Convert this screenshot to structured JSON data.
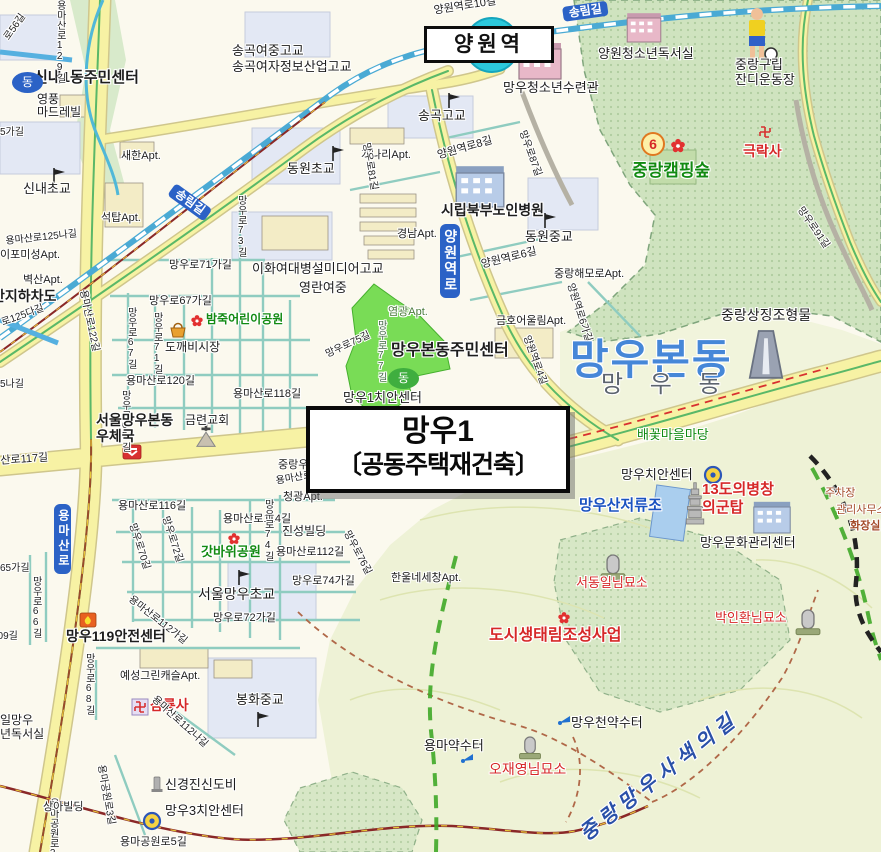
{
  "station": {
    "name": "양원역"
  },
  "callout": {
    "line1": "망우1",
    "line2": "〔공동주택재건축〕"
  },
  "colors": {
    "highlight_zone": "#5cd634",
    "road_yellow": "#f7f2a4",
    "forest_green": "#cfe3bf",
    "railway_blue": "#4aaad4",
    "badge_blue": "#2b62c6",
    "poi_red": "#d62828",
    "park_green": "#128a12",
    "district_blue": "#4687d8"
  },
  "labels": [
    {
      "n": "yangwonyeokro-10gil",
      "t": "양원역로10길",
      "x": 433,
      "y": 5,
      "fs": 11,
      "r": -9
    },
    {
      "n": "songnimgil-badge-top",
      "t": "송림길",
      "x": 562,
      "y": 7,
      "fs": 12,
      "bg": "#2b62c6",
      "r": -8,
      "b": 1
    },
    {
      "n": "songgok-girls-mid-high",
      "t": "송곡여중고교",
      "x": 232,
      "y": 44,
      "fs": 13
    },
    {
      "n": "songgok-girls-info-high",
      "t": "송곡여자정보산업고교",
      "x": 232,
      "y": 60,
      "fs": 13
    },
    {
      "n": "sinnae1-community-center",
      "t": "신내1동주민센터",
      "x": 34,
      "y": 70,
      "fs": 15,
      "b": 1
    },
    {
      "n": "dong-office-icon-sinnae",
      "t": "동",
      "x": 12,
      "y": 72,
      "fs": 12,
      "c": "#fff",
      "bg": "#2b62c6",
      "br": "50%",
      "wd": 19,
      "hg": 19
    },
    {
      "n": "yeongpung-madrevil",
      "t": "영풍\n마드레빌",
      "x": 37,
      "y": 93,
      "fs": 12
    },
    {
      "n": "sinnae-elementary",
      "t": "신내초교",
      "x": 23,
      "y": 182,
      "fs": 13
    },
    {
      "n": "saehan-apt",
      "t": "새한Apt.",
      "x": 121,
      "y": 150,
      "fs": 11
    },
    {
      "n": "seoktap-apt",
      "t": "석탑Apt.",
      "x": 101,
      "y": 212,
      "fs": 11
    },
    {
      "n": "yongmasanro-129gil",
      "t": "용마산로129길",
      "x": 54,
      "y": 0,
      "fs": 10,
      "v": 1
    },
    {
      "n": "ro-56gil",
      "t": "로56길",
      "x": 2,
      "y": 36,
      "fs": 10,
      "r": -55
    },
    {
      "n": "partial-5gagil",
      "t": "5가길",
      "x": 0,
      "y": 127,
      "fs": 10
    },
    {
      "n": "yongmasanro-125nagil",
      "t": "용마산로125나길",
      "x": 5,
      "y": 236,
      "fs": 10,
      "r": -6
    },
    {
      "n": "haipomiseong-apt",
      "t": "이포미성Apt.",
      "x": 0,
      "y": 249,
      "fs": 11
    },
    {
      "n": "byeoksan-apt",
      "t": "벽산Apt.",
      "x": 23,
      "y": 274,
      "fs": 11
    },
    {
      "n": "underpass",
      "t": "안지하차도",
      "x": -8,
      "y": 289,
      "fs": 14,
      "b": 1
    },
    {
      "n": "yongmasanro-125dagil",
      "t": "로125다길",
      "x": 0,
      "y": 318,
      "fs": 10,
      "r": -20
    },
    {
      "n": "partial-5nagil",
      "t": "5나길",
      "x": 0,
      "y": 379,
      "fs": 10
    },
    {
      "n": "partial-65gagil",
      "t": "65가길",
      "x": 0,
      "y": 563,
      "fs": 10
    },
    {
      "n": "songnimgil-badge-west",
      "t": "송림길",
      "x": 176,
      "y": 183,
      "fs": 12,
      "bg": "#2b62c6",
      "r": 36,
      "b": 1
    },
    {
      "n": "mangwooro-73gil",
      "t": "망우로73길",
      "x": 235,
      "y": 195,
      "fs": 10,
      "v": 1
    },
    {
      "n": "dongwon-elementary",
      "t": "동원초교",
      "x": 287,
      "y": 162,
      "fs": 13
    },
    {
      "n": "gaenari-apt",
      "t": "개나리Apt.",
      "x": 361,
      "y": 149,
      "fs": 11
    },
    {
      "n": "songgok-high",
      "t": "송곡고교",
      "x": 418,
      "y": 109,
      "fs": 13
    },
    {
      "n": "yangwonyeokro-8gil",
      "t": "양원역로8길",
      "x": 436,
      "y": 150,
      "fs": 11,
      "r": -16
    },
    {
      "n": "mangwoo-youth-center",
      "t": "망우청소년수련관",
      "x": 503,
      "y": 81,
      "fs": 13
    },
    {
      "n": "mangwooro-87gil",
      "t": "망우로87길",
      "x": 527,
      "y": 129,
      "fs": 10,
      "r": 70
    },
    {
      "n": "yangwon-youth-reading",
      "t": "양원청소년독서실",
      "x": 598,
      "y": 47,
      "fs": 13
    },
    {
      "n": "jungnang-lawn-field",
      "t": "중랑구립\n잔디운동장",
      "x": 735,
      "y": 58,
      "fs": 13
    },
    {
      "n": "geukraksa-temple",
      "t": "극락사",
      "x": 743,
      "y": 144,
      "fs": 14,
      "c": "#d62828",
      "b": 1
    },
    {
      "n": "six-marker",
      "t": "6",
      "x": 641,
      "y": 132,
      "fs": 14,
      "c": "#d62828",
      "b": 1,
      "bg": "#fdf0a8",
      "bd": "2px solid #e07820",
      "br": "50%",
      "wd": 20,
      "hg": 20
    },
    {
      "n": "jungnang-camping-forest",
      "t": "중랑캠핑숲",
      "x": 632,
      "y": 161,
      "fs": 17,
      "c": "#128a12",
      "b": 1
    },
    {
      "n": "ehwa-media-high",
      "t": "이화여대병설미디어고교",
      "x": 252,
      "y": 262,
      "fs": 13
    },
    {
      "n": "yeongnan-girls-mid",
      "t": "영란여중",
      "x": 299,
      "y": 281,
      "fs": 13
    },
    {
      "n": "mangwooro-71gagil",
      "t": "망우로71가길",
      "x": 169,
      "y": 259,
      "fs": 11
    },
    {
      "n": "mangwooro-67gagil",
      "t": "망우로67가길",
      "x": 149,
      "y": 295,
      "fs": 11
    },
    {
      "n": "bamjuk-children-park",
      "t": "밤죽어린이공원",
      "x": 206,
      "y": 313,
      "fs": 12,
      "c": "#128a12",
      "b": 1
    },
    {
      "n": "dokkaebi-market",
      "t": "도깨비시장",
      "x": 165,
      "y": 341,
      "fs": 12
    },
    {
      "n": "yongmasanro-120gil",
      "t": "용마산로120길",
      "x": 126,
      "y": 375,
      "fs": 11
    },
    {
      "n": "yongmasanro-118gil",
      "t": "용마산로118길",
      "x": 233,
      "y": 388,
      "fs": 11
    },
    {
      "n": "mangwooro-67gil",
      "t": "망우로67길",
      "x": 125,
      "y": 307,
      "fs": 10,
      "v": 1
    },
    {
      "n": "mangwooro-71gil",
      "t": "망우로71길",
      "x": 151,
      "y": 312,
      "fs": 10,
      "v": 1
    },
    {
      "n": "yongmasanro-122gil",
      "t": "용마산로122길",
      "x": 88,
      "y": 289,
      "fs": 10,
      "r": 78
    },
    {
      "n": "mangwooro-65gil",
      "t": "망우로65길",
      "x": 119,
      "y": 390,
      "fs": 10,
      "v": 1
    },
    {
      "n": "gyeongnam-apt",
      "t": "경남Apt.",
      "x": 397,
      "y": 228,
      "fs": 11
    },
    {
      "n": "sibuk-senior-hospital",
      "t": "시립북부노인병원",
      "x": 441,
      "y": 203,
      "fs": 14,
      "b": 1
    },
    {
      "n": "dongwon-middle",
      "t": "동원중교",
      "x": 525,
      "y": 230,
      "fs": 13
    },
    {
      "n": "yangwonyeokro-6gil",
      "t": "양원역로6길",
      "x": 480,
      "y": 259,
      "fs": 11,
      "r": -14
    },
    {
      "n": "jungnang-haemoro-apt",
      "t": "중랑해모로Apt.",
      "x": 554,
      "y": 268,
      "fs": 11
    },
    {
      "n": "geumho-apt",
      "t": "금호어울림Apt.",
      "x": 496,
      "y": 315,
      "fs": 11
    },
    {
      "n": "mangwooro-81gil",
      "t": "망우로81길",
      "x": 371,
      "y": 142,
      "fs": 10,
      "r": 80
    },
    {
      "n": "yangwonyeokro-badge",
      "t": "양원역로",
      "x": 440,
      "y": 224,
      "fs": 14,
      "bg": "#2b62c6",
      "v": 1,
      "b": 1,
      "ls": 2
    },
    {
      "n": "yangwonyeokro-4gil",
      "t": "양원역로4길",
      "x": 531,
      "y": 334,
      "fs": 10,
      "r": 70
    },
    {
      "n": "yangwonyeokro-6gagil",
      "t": "양원역로6가길",
      "x": 575,
      "y": 282,
      "fs": 10,
      "r": 72
    },
    {
      "n": "mangwoobon-dong-big",
      "t": "망우본동",
      "x": 570,
      "y": 336,
      "fs": 42,
      "c": "#4687d8",
      "b": 1,
      "ls": 2
    },
    {
      "n": "mangwoo-dong",
      "t": "망 우 동",
      "x": 601,
      "y": 372,
      "fs": 24,
      "c": "#5c646e",
      "ls": 10
    },
    {
      "n": "mangwoobon-community-center",
      "t": "망우본동주민센터",
      "x": 391,
      "y": 342,
      "fs": 16,
      "b": 1
    },
    {
      "n": "yeomgwang-apt",
      "t": "염광Apt.",
      "x": 388,
      "y": 306,
      "fs": 11,
      "c": "#4a7a3a"
    },
    {
      "n": "mangwooro-77gil",
      "t": "망우로77길",
      "x": 375,
      "y": 320,
      "fs": 10,
      "v": 1,
      "c": "#46684a"
    },
    {
      "n": "mangwooro-75gil",
      "t": "망우로75길",
      "x": 324,
      "y": 350,
      "fs": 10,
      "r": -25
    },
    {
      "n": "dong-office-icon-mangwoo",
      "t": "동",
      "x": 388,
      "y": 368,
      "fs": 12,
      "c": "#fff",
      "bg": "#3fae3f",
      "br": "50%",
      "wd": 19,
      "hg": 19
    },
    {
      "n": "mangwoo1-police-box",
      "t": "망우1치안센터",
      "x": 343,
      "y": 391,
      "fs": 13
    },
    {
      "n": "jungnang-u-partial",
      "t": "중랑우",
      "x": 278,
      "y": 459,
      "fs": 11
    },
    {
      "n": "yongmasanro-partial",
      "t": "용마산로",
      "x": 275,
      "y": 476,
      "fs": 10,
      "r": -10
    },
    {
      "n": "mangwoo-post-office",
      "t": "서울망우본동\n우체국",
      "x": 96,
      "y": 413,
      "fs": 14,
      "b": 1
    },
    {
      "n": "geumnyeon-church",
      "t": "금련교회",
      "x": 185,
      "y": 414,
      "fs": 12
    },
    {
      "n": "partial-sanro117gil",
      "t": "산로117길",
      "x": 0,
      "y": 455,
      "fs": 11,
      "r": -4
    },
    {
      "n": "yongmasanro-116gil",
      "t": "용마산로116길",
      "x": 118,
      "y": 500,
      "fs": 11
    },
    {
      "n": "yongmasanro-114gil",
      "t": "용마산로114길",
      "x": 223,
      "y": 513,
      "fs": 11
    },
    {
      "n": "gatbawi-park",
      "t": "갓바위공원",
      "x": 201,
      "y": 545,
      "fs": 13,
      "c": "#128a12",
      "b": 1
    },
    {
      "n": "mangwooro-70gil",
      "t": "망우로70길",
      "x": 137,
      "y": 522,
      "fs": 10,
      "r": 72
    },
    {
      "n": "mangwooro-72gil",
      "t": "망우로72길",
      "x": 170,
      "y": 515,
      "fs": 10,
      "r": 72
    },
    {
      "n": "seoul-mangwoo-elementary",
      "t": "서울망우초교",
      "x": 198,
      "y": 587,
      "fs": 14
    },
    {
      "n": "mangwooro-72gagil",
      "t": "망우로72가길",
      "x": 213,
      "y": 612,
      "fs": 11
    },
    {
      "n": "yongmasanro-112gagil",
      "t": "용마산로112가길",
      "x": 133,
      "y": 594,
      "fs": 10,
      "r": 38
    },
    {
      "n": "cheonggwang-apt",
      "t": "청광Apt.",
      "x": 283,
      "y": 491,
      "fs": 11
    },
    {
      "n": "jinseong-building",
      "t": "진성빌딩",
      "x": 282,
      "y": 525,
      "fs": 12
    },
    {
      "n": "yongmasanro-112gil",
      "t": "용마산로112길",
      "x": 276,
      "y": 546,
      "fs": 11
    },
    {
      "n": "mangwooro-74gil",
      "t": "망우로74길",
      "x": 262,
      "y": 499,
      "fs": 10,
      "v": 1
    },
    {
      "n": "mangwooro-76gil",
      "t": "망우로76길",
      "x": 351,
      "y": 529,
      "fs": 10,
      "r": 62
    },
    {
      "n": "mangwooro-74gagil",
      "t": "망우로74가길",
      "x": 292,
      "y": 575,
      "fs": 11
    },
    {
      "n": "hanulne-apt",
      "t": "한울네세창Apt.",
      "x": 391,
      "y": 572,
      "fs": 11
    },
    {
      "n": "mangwooro-66gil",
      "t": "망우로66길",
      "x": 30,
      "y": 576,
      "fs": 10,
      "v": 1
    },
    {
      "n": "partial-109gil",
      "t": "109길",
      "x": -8,
      "y": 631,
      "fs": 10
    },
    {
      "n": "mangwoo-119-center",
      "t": "망우119안전센터",
      "x": 66,
      "y": 629,
      "fs": 14,
      "b": 1
    },
    {
      "n": "yeseong-green-castle-apt",
      "t": "예성그린캐슬Apt.",
      "x": 120,
      "y": 670,
      "fs": 11
    },
    {
      "n": "samryongsa-temple",
      "t": "삼룡사",
      "x": 150,
      "y": 698,
      "fs": 14,
      "c": "#d62828",
      "b": 1
    },
    {
      "n": "yongmasanro-112nagil",
      "t": "용마산로112나길",
      "x": 157,
      "y": 694,
      "fs": 10,
      "r": 42
    },
    {
      "n": "mangwooro-68gil",
      "t": "망우로68길",
      "x": 83,
      "y": 653,
      "fs": 10,
      "v": 1
    },
    {
      "n": "bonghwa-middle",
      "t": "봉화중교",
      "x": 236,
      "y": 693,
      "fs": 13
    },
    {
      "n": "reading-room-partial-1",
      "t": "일망우",
      "x": 0,
      "y": 714,
      "fs": 12
    },
    {
      "n": "reading-room-partial-2",
      "t": "년독서실",
      "x": 0,
      "y": 728,
      "fs": 12
    },
    {
      "n": "singyeongjin-monument",
      "t": "신경진신도비",
      "x": 165,
      "y": 778,
      "fs": 13
    },
    {
      "n": "mangwoo3-police-box",
      "t": "망우3치안센터",
      "x": 165,
      "y": 804,
      "fs": 13
    },
    {
      "n": "yongmagongwonro-5gil",
      "t": "용마공원로5길",
      "x": 120,
      "y": 836,
      "fs": 11
    },
    {
      "n": "yongmagongwonro-3gil",
      "t": "용마공원로3길",
      "x": 106,
      "y": 764,
      "fs": 10,
      "r": 80
    },
    {
      "n": "yongmagongwonro-2gil",
      "t": "용마공원로2길",
      "x": 47,
      "y": 798,
      "fs": 10,
      "v": 1
    },
    {
      "n": "sanga-building",
      "t": "상아빌딩",
      "x": 43,
      "y": 801,
      "fs": 11
    },
    {
      "n": "yongmasanro-badge",
      "t": "용마산로",
      "x": 54,
      "y": 504,
      "fs": 12,
      "bg": "#2b62c6",
      "v": 1,
      "b": 1,
      "ls": 3
    },
    {
      "n": "jungnang-symbol-sculpture",
      "t": "중랑상징조형물",
      "x": 721,
      "y": 308,
      "fs": 14
    },
    {
      "n": "mangwooro-91gil",
      "t": "망우로91길",
      "x": 804,
      "y": 205,
      "fs": 10,
      "r": 55
    },
    {
      "n": "baekkot-village-yard",
      "t": "배꽃마을마당",
      "x": 637,
      "y": 428,
      "fs": 13,
      "c": "#128a12"
    },
    {
      "n": "ro-badge",
      "t": "로",
      "x": 545,
      "y": 439,
      "fs": 11,
      "bg": "#2b62c6",
      "r": -8,
      "b": 1
    },
    {
      "n": "mangwoo-police-box",
      "t": "망우치안센터",
      "x": 621,
      "y": 468,
      "fs": 13
    },
    {
      "n": "mangwoosan-reservoir",
      "t": "망우산저류조",
      "x": 579,
      "y": 498,
      "fs": 15,
      "c": "#1a52c0",
      "b": 1
    },
    {
      "n": "uibyeong-tower-line1",
      "t": "13도의병창",
      "x": 702,
      "y": 482,
      "fs": 15,
      "c": "#d62828",
      "b": 1
    },
    {
      "n": "uibyeong-tower-line2",
      "t": "의군탑",
      "x": 702,
      "y": 500,
      "fs": 15,
      "c": "#d62828",
      "b": 1
    },
    {
      "n": "mangwoo-culture-center",
      "t": "망우문화관리센터",
      "x": 700,
      "y": 536,
      "fs": 13
    },
    {
      "n": "parking-lot",
      "t": "주차장",
      "x": 825,
      "y": 487,
      "fs": 11,
      "c": "#a34a28"
    },
    {
      "n": "management-office",
      "t": "관리사무소",
      "x": 836,
      "y": 504,
      "fs": 11,
      "c": "#a34a28"
    },
    {
      "n": "restroom",
      "t": "화장실",
      "x": 850,
      "y": 520,
      "fs": 11,
      "c": "#a34a28",
      "b": 1
    },
    {
      "n": "seodongil-grave",
      "t": "서동일님묘소",
      "x": 576,
      "y": 576,
      "fs": 13,
      "c": "#d62828"
    },
    {
      "n": "parkinhwan-grave",
      "t": "박인환님묘소",
      "x": 715,
      "y": 611,
      "fs": 13,
      "c": "#d62828"
    },
    {
      "n": "urban-eco-forest-project",
      "t": "도시생태림조성사업",
      "x": 489,
      "y": 627,
      "fs": 16,
      "c": "#d62828",
      "b": 1
    },
    {
      "n": "yongma-mineral-spring",
      "t": "용마약수터",
      "x": 424,
      "y": 739,
      "fs": 13
    },
    {
      "n": "ojaeyoung-grave",
      "t": "오재영님묘소",
      "x": 489,
      "y": 762,
      "fs": 14,
      "c": "#d62828"
    },
    {
      "n": "mangwoocheon-spring",
      "t": "망우천약수터",
      "x": 571,
      "y": 716,
      "fs": 13
    },
    {
      "n": "sasaek-trail",
      "t": "중랑망우사색의길",
      "x": 576,
      "y": 828,
      "fs": 20,
      "c": "#2a50a8",
      "b": 1,
      "it": 1,
      "r": -38,
      "ls": 6
    }
  ]
}
